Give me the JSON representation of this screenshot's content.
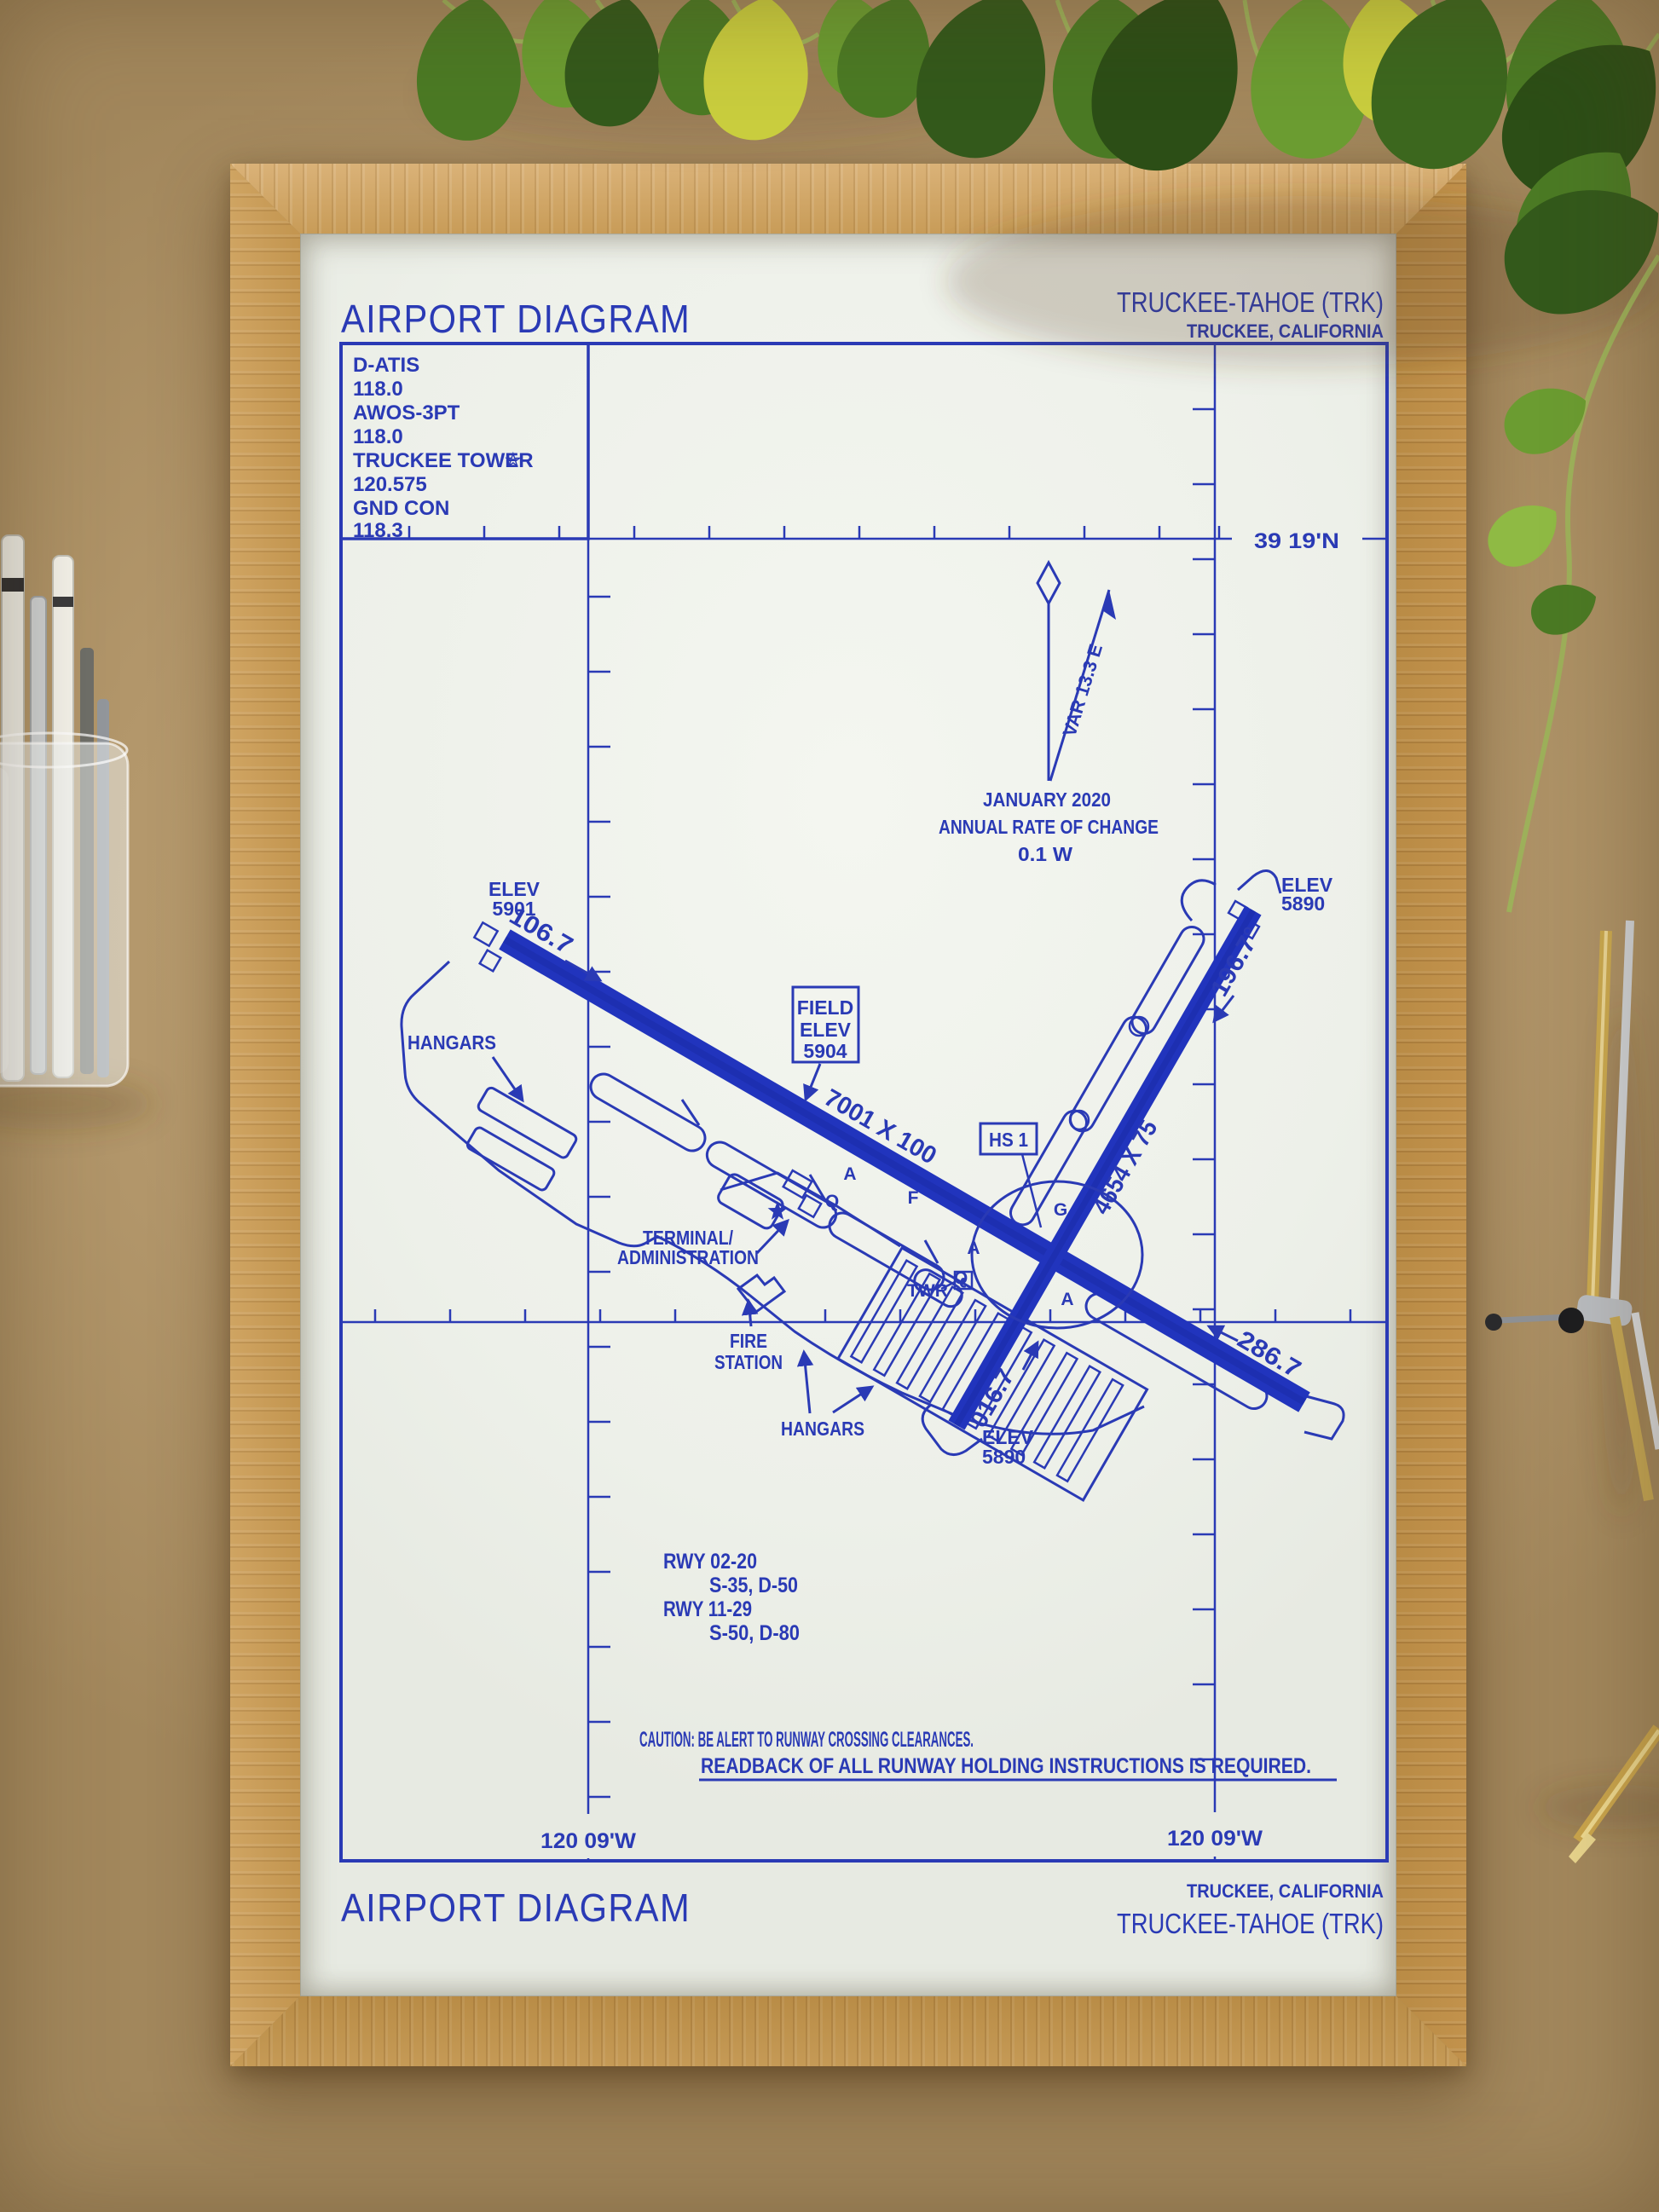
{
  "colors": {
    "ink_blue": "#2a3ab5",
    "paper": "#f0f2ec",
    "frame_oak": "#c89c58",
    "desk_tan": "#b3976b"
  },
  "print": {
    "title_top": "AIRPORT DIAGRAM",
    "airport_top": "TRUCKEE-TAHOE (TRK)",
    "city_top": "TRUCKEE, CALIFORNIA",
    "title_bottom": "AIRPORT DIAGRAM",
    "city_bottom": "TRUCKEE, CALIFORNIA",
    "airport_bottom": "TRUCKEE-TAHOE (TRK)"
  },
  "comm_box": [
    "D-ATIS",
    "118.0",
    "AWOS-3PT",
    "118.0",
    "TRUCKEE TOWER",
    "120.575",
    "GND CON",
    "118.3"
  ],
  "comm_box_star": "☆",
  "graticule": {
    "lat": "39 19'N",
    "lon_left": "120 09'W",
    "lon_right": "120 09'W"
  },
  "variation": {
    "label": "VAR 13.3 E",
    "line1": "JANUARY 2020",
    "line2": "ANNUAL RATE OF CHANGE",
    "line3": "0.1  W"
  },
  "field_elev": {
    "l1": "FIELD",
    "l2": "ELEV",
    "l3": "5904"
  },
  "hotspot": {
    "label": "HS 1"
  },
  "elevations": {
    "rwy11": [
      "ELEV",
      "5901"
    ],
    "rwy20": [
      "ELEV",
      "5890"
    ],
    "rwy02": [
      "ELEV",
      "5890"
    ]
  },
  "runways": {
    "rwy1129": {
      "size": "7001 X 100",
      "hdg11": "106.7",
      "hdg29": "286.7"
    },
    "rwy0220": {
      "size": "4654 X 75",
      "hdg20": "196.7°",
      "hdg02": "016.7"
    }
  },
  "buildings": {
    "hangars_nw": "HANGARS",
    "terminal1": "TERMINAL/",
    "terminal2": "ADMINISTRATION",
    "fire1": "FIRE",
    "fire2": "STATION",
    "hangars_s": "HANGARS",
    "tower": "TWR"
  },
  "taxiways": [
    "A",
    "F",
    "Q",
    "A",
    "G",
    "Q",
    "A"
  ],
  "runway_data": {
    "r1": "RWY 02-20",
    "r1d": "S-35, D-50",
    "r2": "RWY 11-29",
    "r2d": "S-50, D-80"
  },
  "caution": {
    "line1": "CAUTION: BE ALERT TO RUNWAY CROSSING CLEARANCES.",
    "line2": "READBACK OF ALL RUNWAY HOLDING INSTRUCTIONS IS REQUIRED."
  }
}
